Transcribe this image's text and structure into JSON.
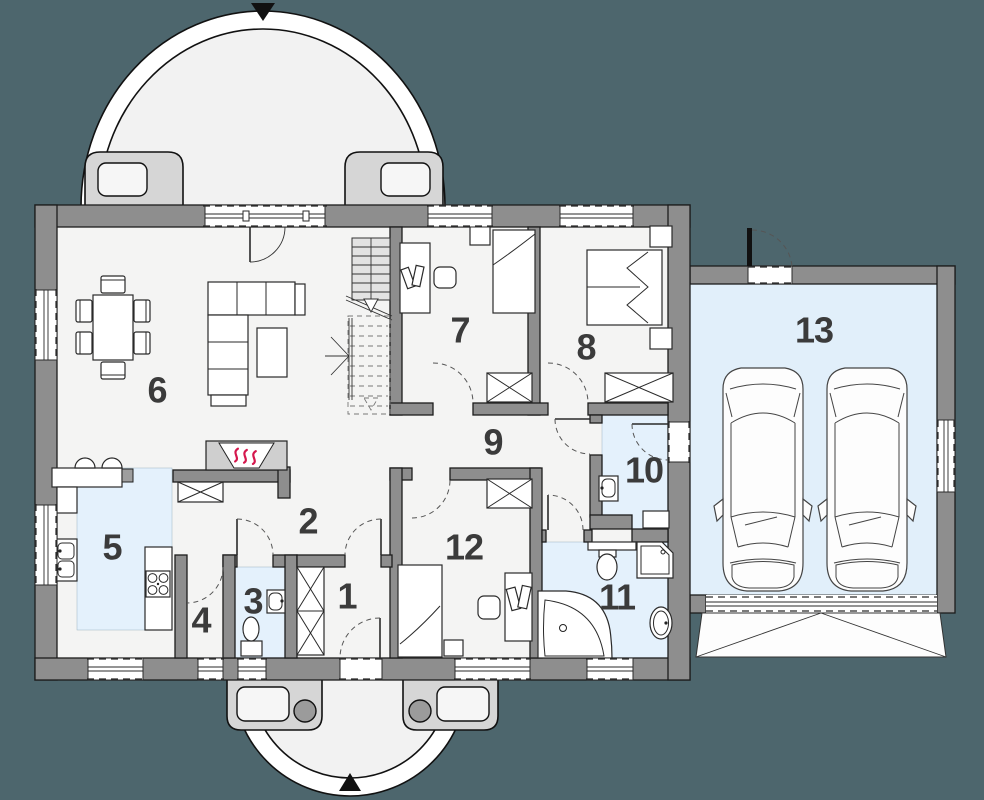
{
  "title": "single-storey house floor plan with double garage",
  "palette": {
    "background": "#4d666d",
    "wall": "#8e8e8e",
    "floor": "#f4f4f3",
    "wet_floor": "#e4f1fc",
    "garage_floor": "#e1effa",
    "porch": "#d6d6d6",
    "accent_red": "#d5174d",
    "line": "#1c1c1c"
  },
  "rooms": [
    {
      "number": "1"
    },
    {
      "number": "2"
    },
    {
      "number": "3"
    },
    {
      "number": "4"
    },
    {
      "number": "5"
    },
    {
      "number": "6"
    },
    {
      "number": "7"
    },
    {
      "number": "8"
    },
    {
      "number": "9"
    },
    {
      "number": "10"
    },
    {
      "number": "11"
    },
    {
      "number": "12"
    },
    {
      "number": "13"
    }
  ],
  "icons": {
    "entry_arrow_top": "triangle-down",
    "entry_arrow_bottom": "triangle-up",
    "fireplace_heat": "three-red-squiggles",
    "stair_direction": "dashed-arrow-down",
    "wardrobe": "crossed-box",
    "cars_in_garage": 2
  }
}
